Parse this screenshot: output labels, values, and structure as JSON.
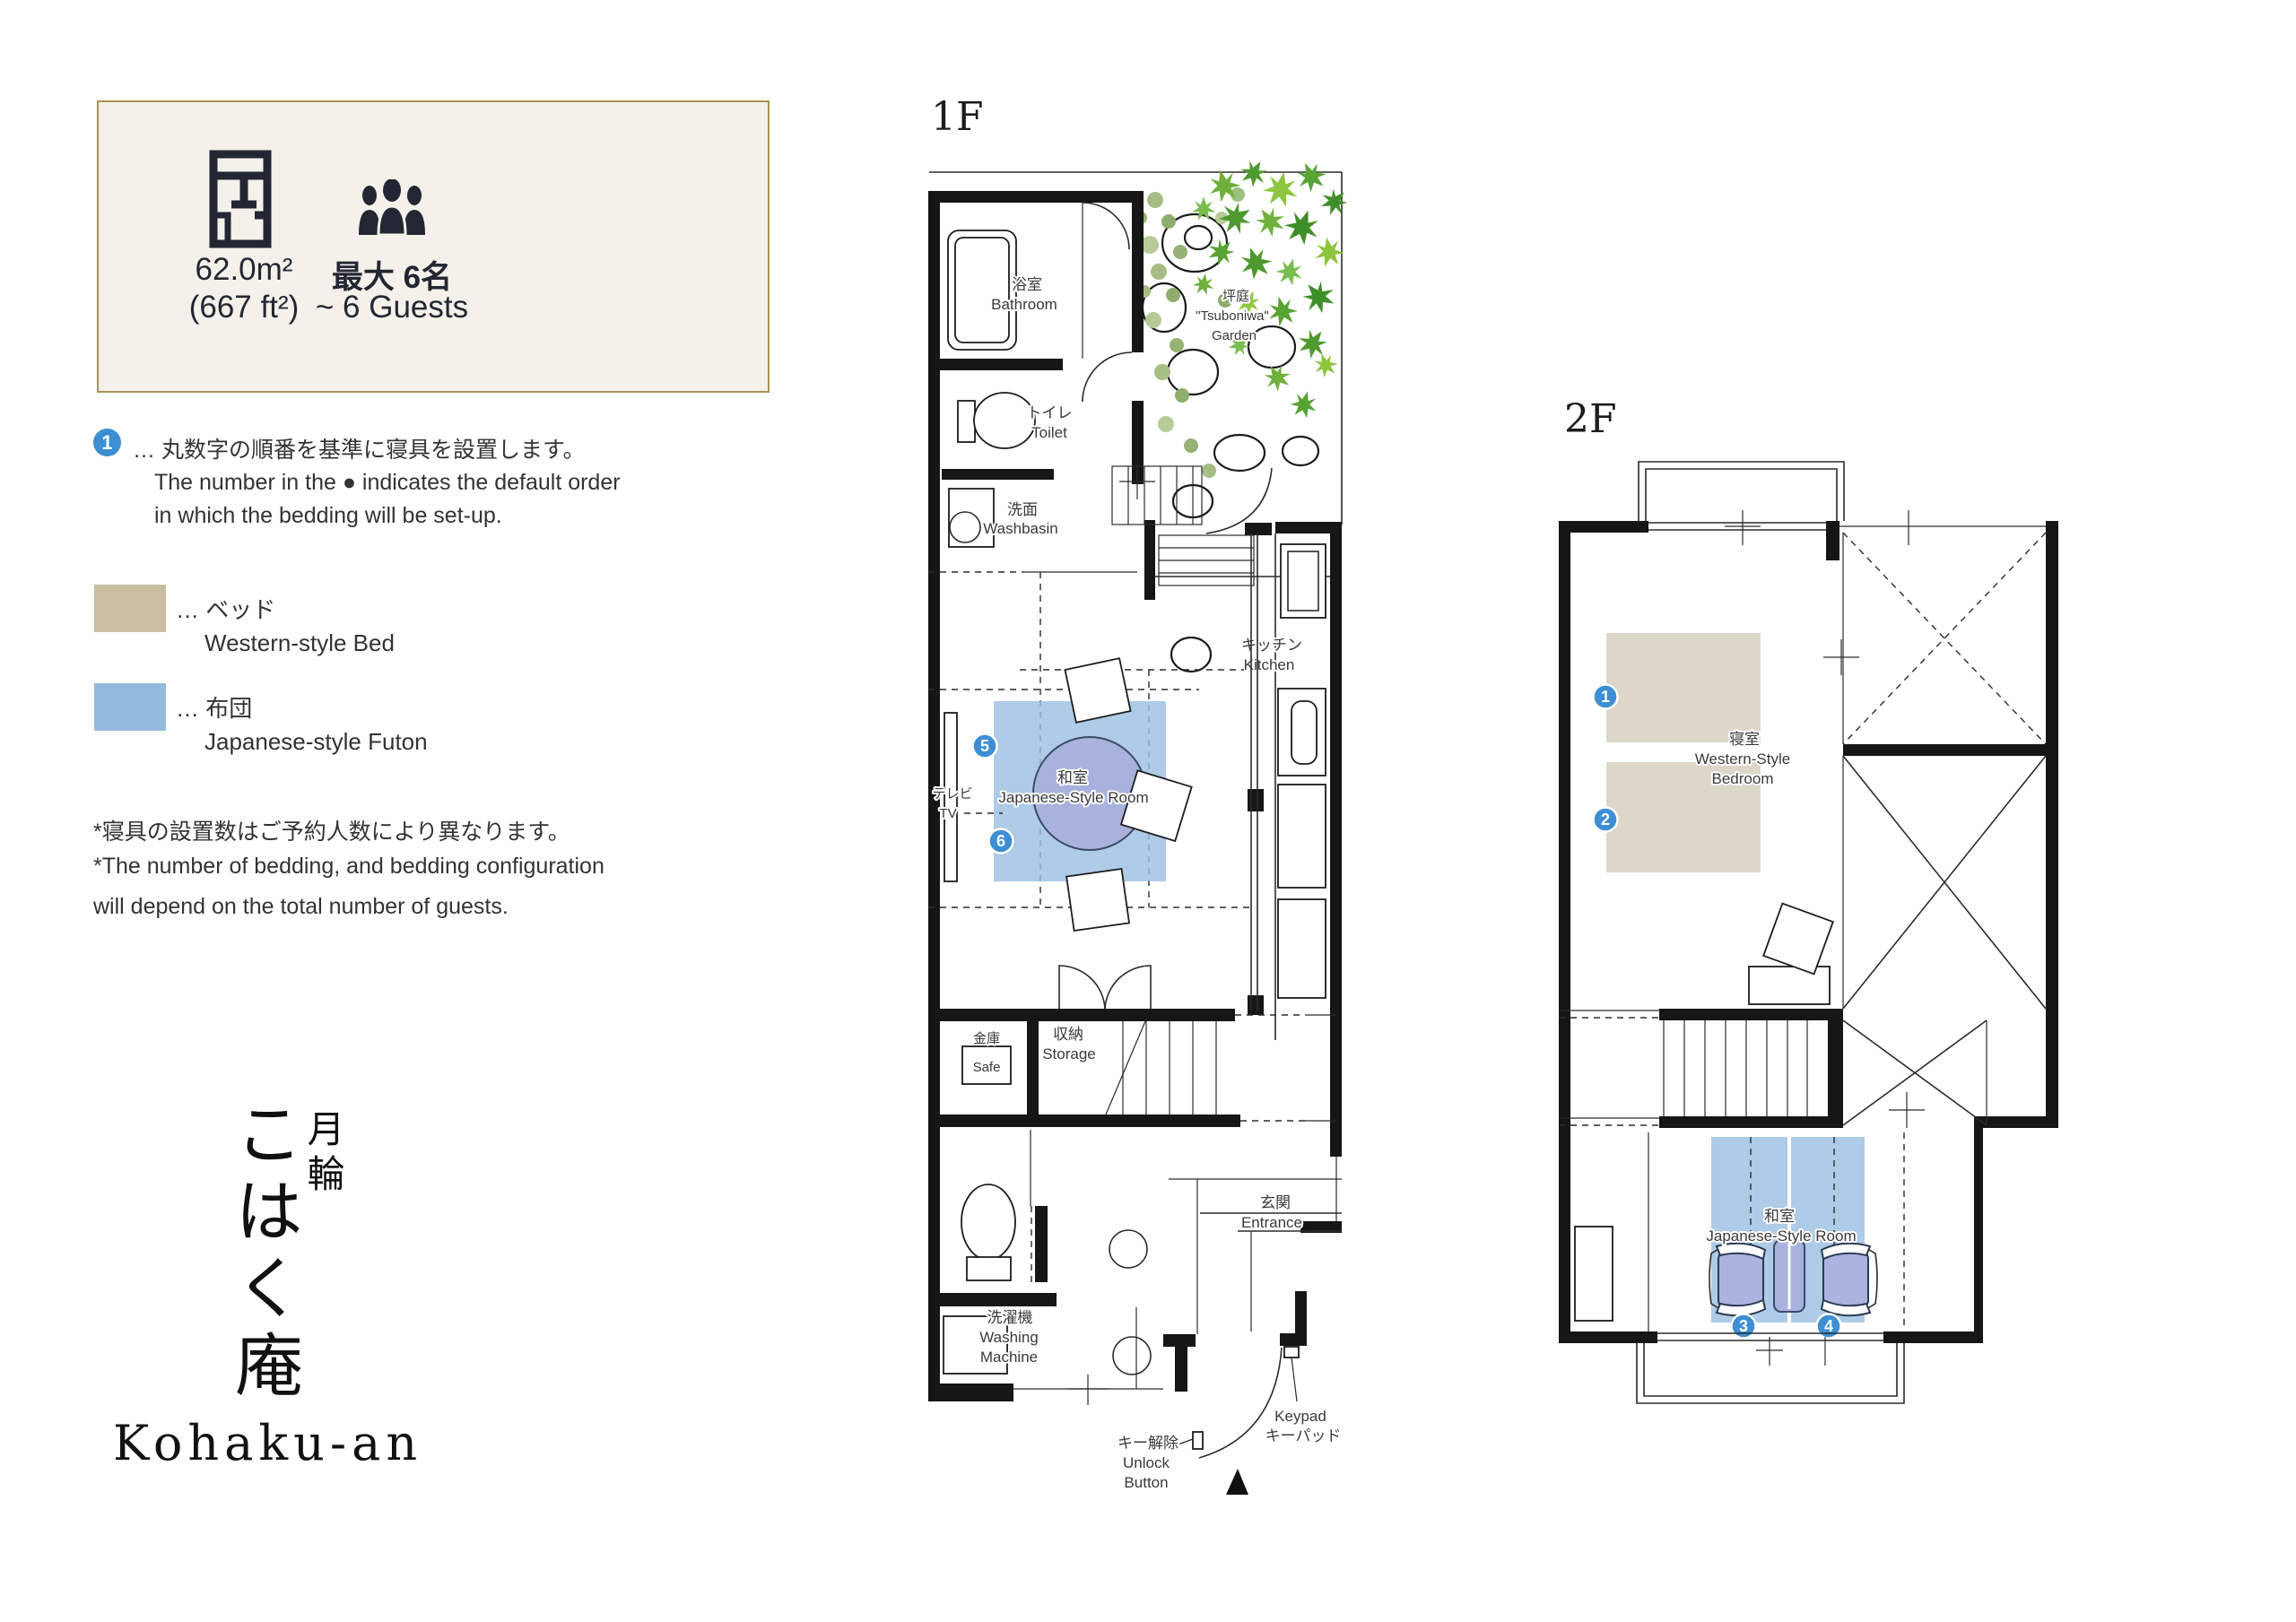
{
  "info_panel": {
    "area_value": "62.0m²",
    "area_alt": "(667 ft²)",
    "capacity_jp": "最大 6名",
    "capacity_en": "~ 6 Guests"
  },
  "bedding_note": {
    "number": "1",
    "line_jp": "… 丸数字の順番を基準に寝具を設置します。",
    "line_en1": "The number in the ● indicates the default order",
    "line_en2": "in which the bedding will be set-up."
  },
  "legend": {
    "bed": {
      "jp": "… ベッド",
      "en": "Western-style Bed",
      "color": "#c9bda2"
    },
    "futon": {
      "jp": "… 布団",
      "en": "Japanese-style Futon",
      "color": "#94badd"
    }
  },
  "notes": {
    "line1": "*寝具の設置数はご予約人数により異なります。",
    "line2": "*The number of bedding, and bedding configuration",
    "line3": " will depend on the total number of guests."
  },
  "title": {
    "kanji_right": "月輪",
    "kana": "こはく庵",
    "romaji": "Kohaku-an"
  },
  "floor1": {
    "label": "1F",
    "bathroom_jp": "浴室",
    "bathroom_en": "Bathroom",
    "toilet_jp": "トイレ",
    "toilet_en": "Toilet",
    "washbasin_jp": "洗面",
    "washbasin_en": "Washbasin",
    "garden_jp": "坪庭",
    "garden_en1": "\"Tsuboniwa\"",
    "garden_en2": "Garden",
    "kitchen_jp": "キッチン",
    "kitchen_en": "Kitchen",
    "tatami_jp": "和室",
    "tatami_en": "Japanese-Style Room",
    "tv_jp": "テレビ",
    "tv_en": "TV",
    "safe_jp": "金庫",
    "safe_en": "Safe",
    "storage_jp": "収納",
    "storage_en": "Storage",
    "entrance_jp": "玄関",
    "entrance_en": "Entrance",
    "washer_jp": "洗濯機",
    "washer_en1": "Washing",
    "washer_en2": "Machine",
    "unlock_jp": "キー解除",
    "unlock_en1": "Unlock",
    "unlock_en2": "Button",
    "keypad_en": "Keypad",
    "keypad_jp": "キーパッド",
    "num5": "5",
    "num6": "6"
  },
  "floor2": {
    "label": "2F",
    "bedroom_jp": "寝室",
    "bedroom_en1": "Western-Style",
    "bedroom_en2": "Bedroom",
    "tatami_jp": "和室",
    "tatami_en": "Japanese-Style Room",
    "num1": "1",
    "num2": "2",
    "num3": "3",
    "num4": "4"
  }
}
